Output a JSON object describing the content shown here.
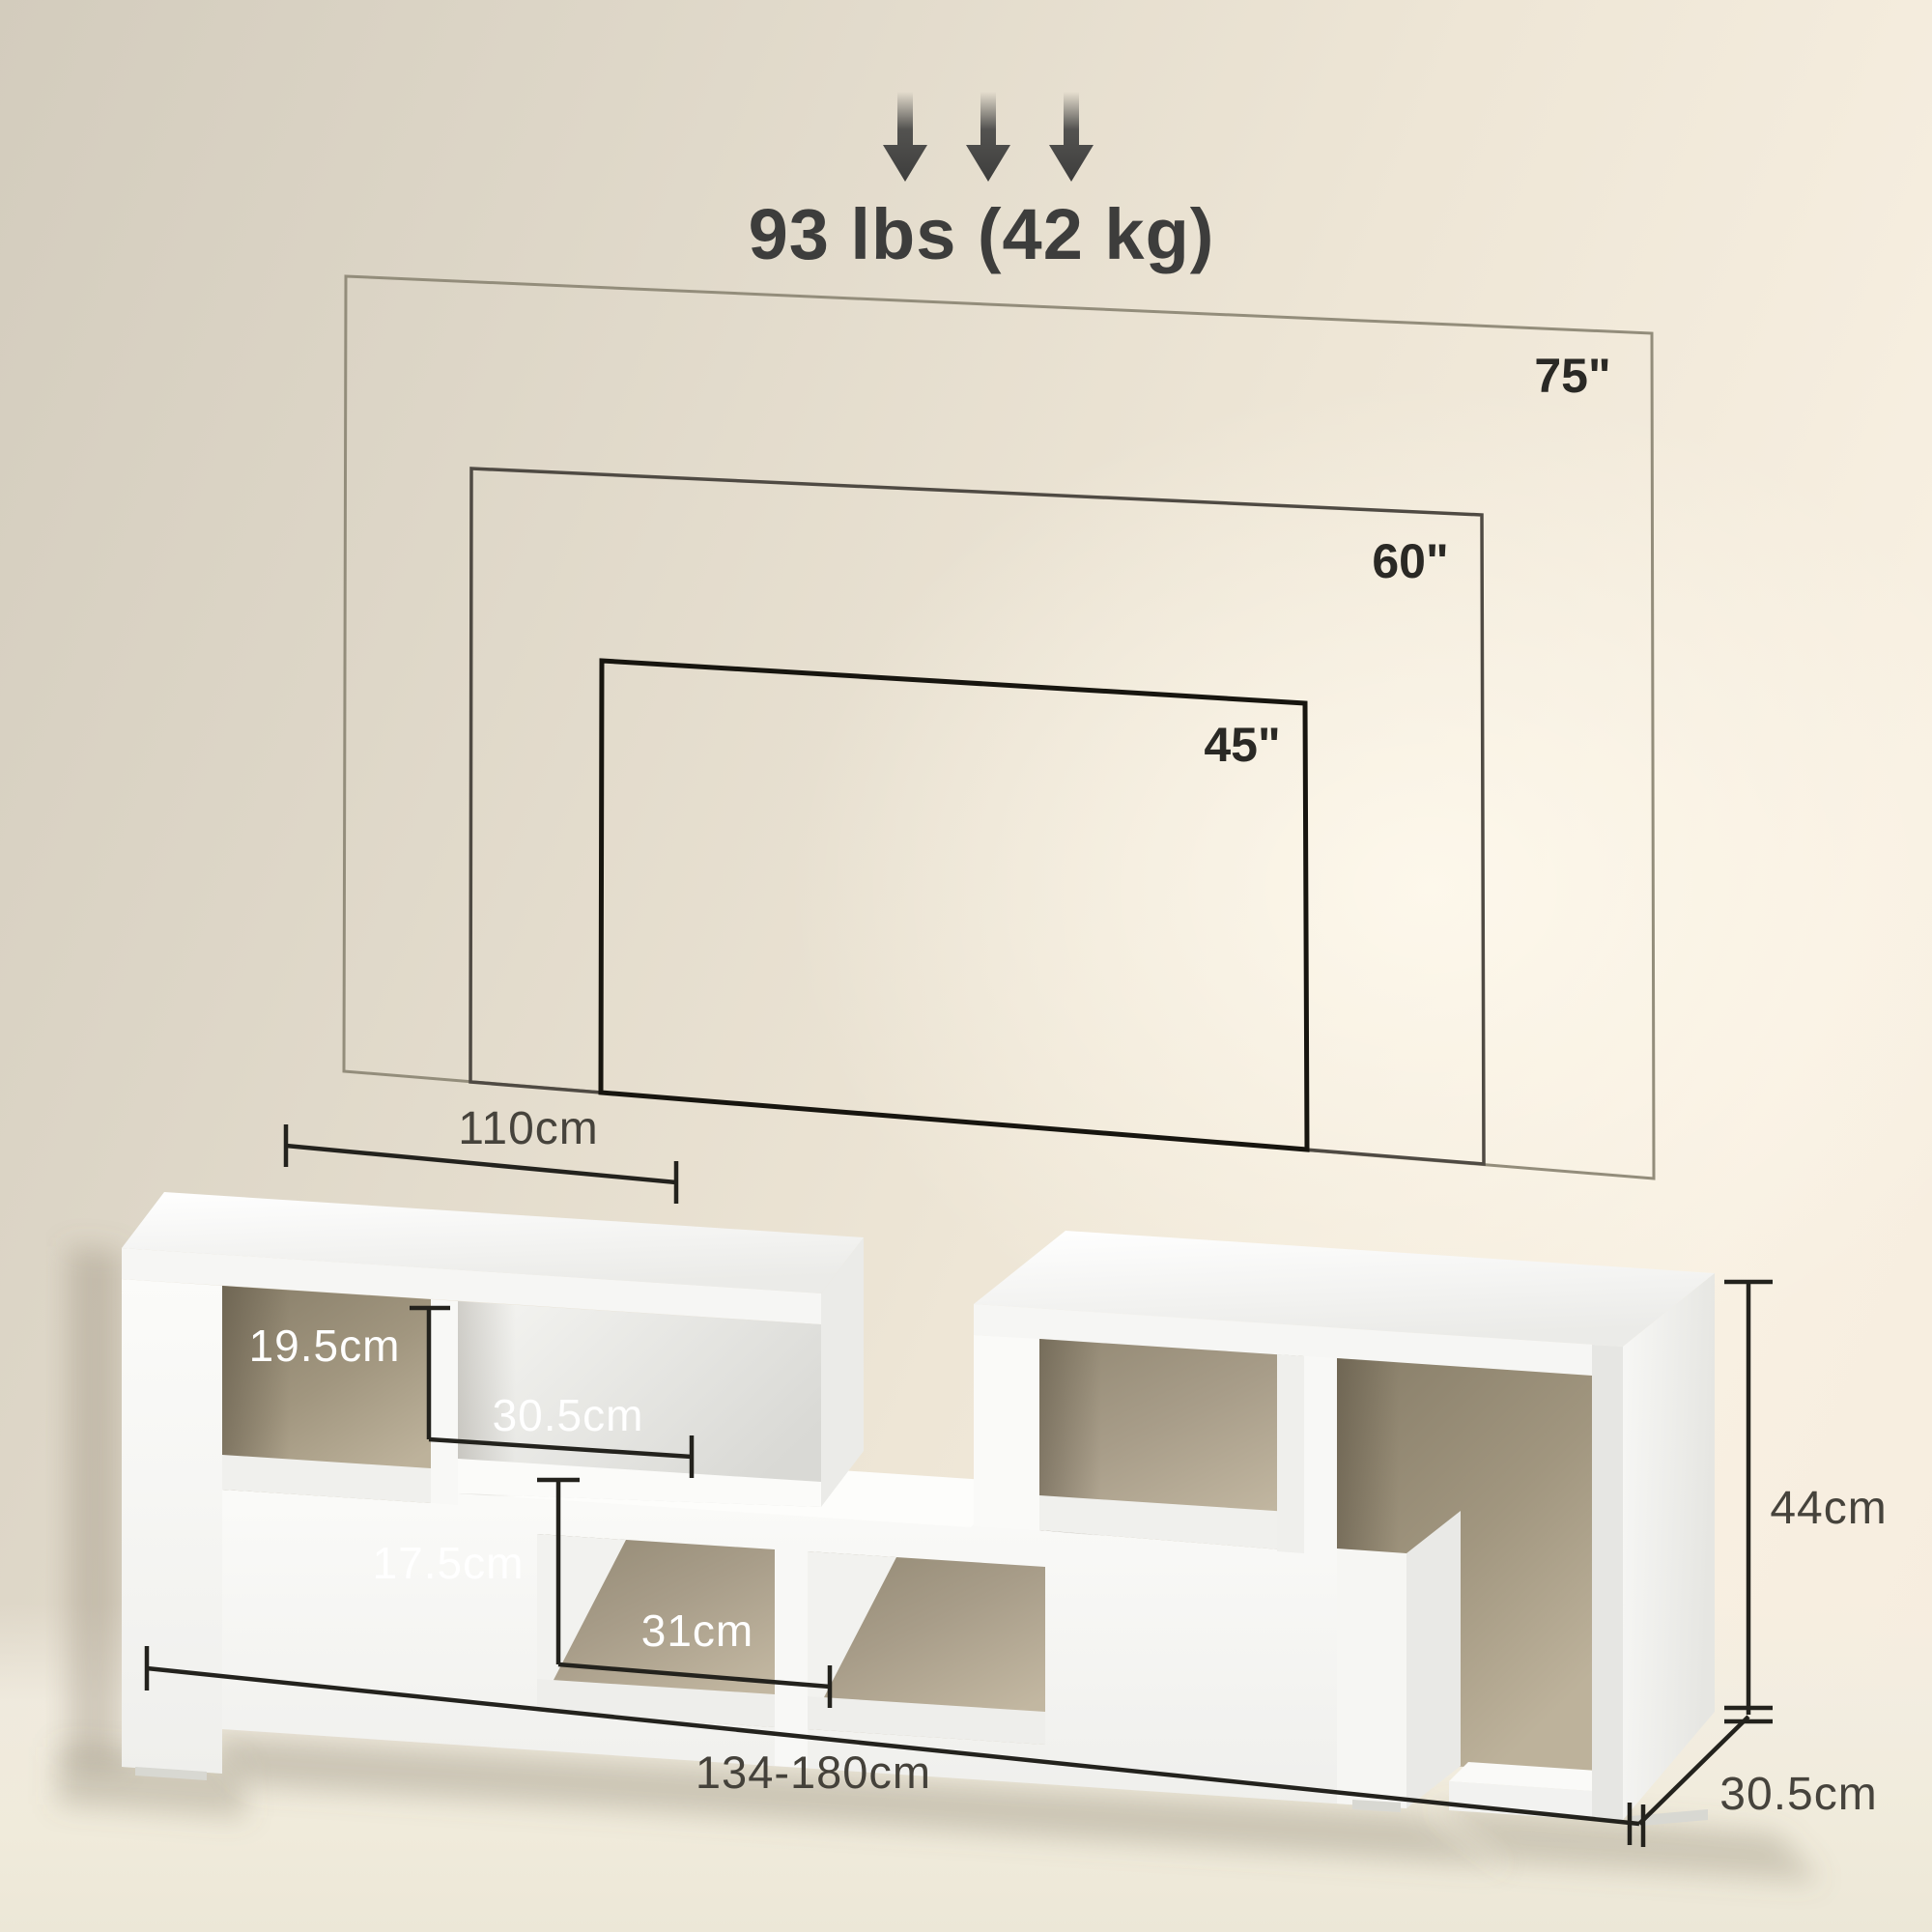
{
  "product_view": {
    "weight_capacity_label": "93 lbs (42 kg)",
    "tv_outlines": [
      {
        "label": "75\"",
        "inches": 75
      },
      {
        "label": "60\"",
        "inches": 60
      },
      {
        "label": "45\"",
        "inches": 45
      }
    ],
    "dimensions": {
      "top_unit_width": "110cm",
      "upper_cubby_height": "19.5cm",
      "upper_cubby_width": "30.5cm",
      "lower_cubby_height": "17.5cm",
      "lower_cubby_width": "31cm",
      "extendable_length": "134-180cm",
      "overall_height": "44cm",
      "depth": "30.5cm"
    },
    "colors": {
      "wall_beige": "#e8e0d0",
      "floor_cream": "#f1ecdc",
      "annotation_dark": "#23221d",
      "label_gray": "#46433c",
      "label_white": "#ffffff",
      "arrow_gray": "#3f3f3e",
      "outline_75": "#938d7b",
      "outline_60": "#4f4a43",
      "outline_45": "#17150f",
      "stand_white": "#fbfbf9",
      "cubby_tan": "#a89d89"
    }
  }
}
